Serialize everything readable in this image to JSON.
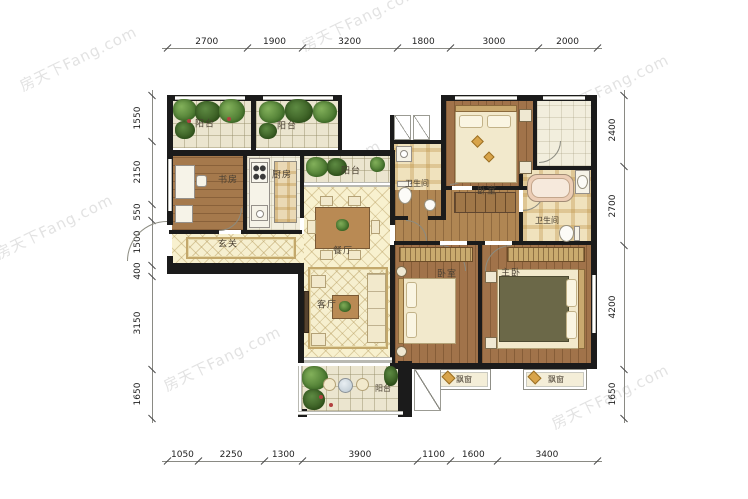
{
  "watermark": {
    "text": "房天下Fang.com",
    "color": "#dcdcdc"
  },
  "dimensions": {
    "top": [
      "2700",
      "1900",
      "3200",
      "1800",
      "3000",
      "2000"
    ],
    "bottom": [
      "1050",
      "2250",
      "1300",
      "3900",
      "1100",
      "1600",
      "3400"
    ],
    "left": [
      "1550",
      "2150",
      "550",
      "1500",
      "400",
      "3150",
      "1650"
    ],
    "right": [
      "2400",
      "2700",
      "4200",
      "1650"
    ]
  },
  "rooms": {
    "balcony_top_left": "阳台",
    "balcony_top_mid": "阳台",
    "study": "书房",
    "kitchen": "厨房",
    "balcony_dining": "阳台",
    "foyer": "玄关",
    "dining": "餐厅",
    "living": "客厅",
    "balcony_bottom": "阳台",
    "bathroom_1": "卫生间",
    "bathroom_2": "卫生间",
    "bedroom_top": "卧室",
    "bedroom_mid": "卧室",
    "master_bedroom": "主卧",
    "bay_window_left": "飘窗",
    "bay_window_right": "飘窗"
  },
  "colors": {
    "wall": "#1b1b1b",
    "tile_floor": "#f8f1cf",
    "wood_floor": "#a5794c",
    "label_text": "#4a4033",
    "dimension_text": "#222222",
    "watermark": "#dcdcdc"
  }
}
